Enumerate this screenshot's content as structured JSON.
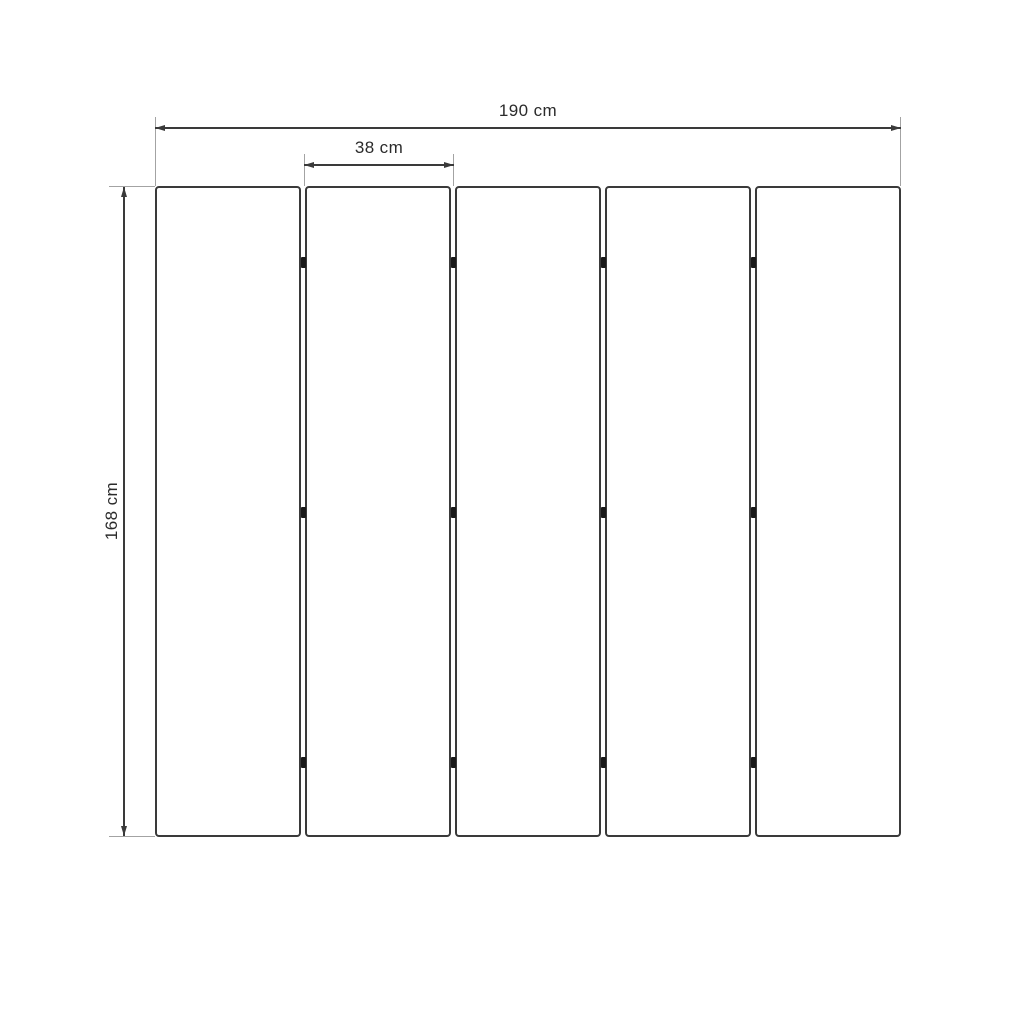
{
  "diagram": {
    "kind": "dimension-drawing",
    "panel_count": 5,
    "hinge_rows": 3,
    "dimensions": {
      "total_width": {
        "label": "190 cm",
        "value": 190,
        "unit": "cm"
      },
      "panel_width": {
        "label": "38 cm",
        "value": 38,
        "unit": "cm"
      },
      "height": {
        "label": "168 cm",
        "value": 168,
        "unit": "cm"
      }
    },
    "colors": {
      "background": "#ffffff",
      "panel_border": "#3a3a3a",
      "dimension_line": "#3a3a3a",
      "extension_line": "#a3a3a3",
      "hinge": "#191919",
      "text": "#2b2b2b"
    }
  }
}
